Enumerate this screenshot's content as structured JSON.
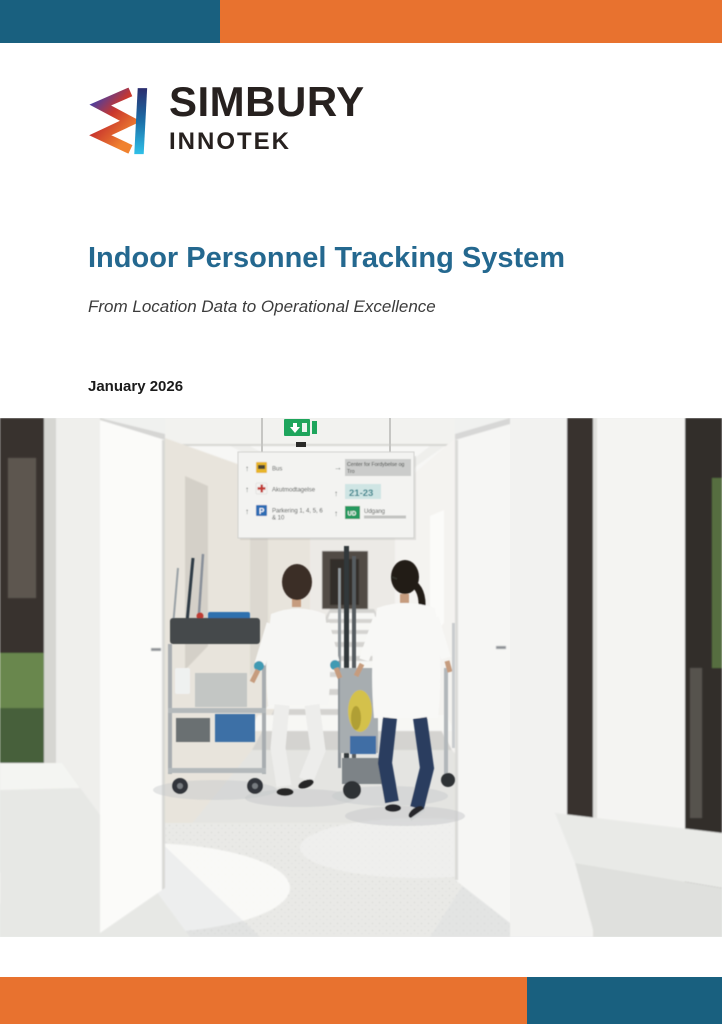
{
  "accent_colors": {
    "teal": "#19607F",
    "orange": "#E8722F",
    "title_blue": "#24688F"
  },
  "logo": {
    "brand": "SIMBURY",
    "sub_brand": "INNOTEK"
  },
  "cover": {
    "title": "Indoor Personnel Tracking System",
    "subtitle": "From Location Data to Operational Excellence",
    "date": "January 2026"
  },
  "photo": {
    "alt": "Two hospital staff members in white uniforms pushing service carts down a bright corridor",
    "signboard": {
      "left_rows": [
        {
          "arrow": "↑",
          "icon": "bus-icon",
          "label": "Bus"
        },
        {
          "arrow": "↑",
          "icon": "emergency-cross-icon",
          "label": "Akutmodtagelse"
        },
        {
          "arrow": "↑",
          "icon": "parking-icon",
          "label_line1": "Parkering 1, 4, 5, 6",
          "label_line2": "& 10"
        }
      ],
      "right_rows": [
        {
          "arrow": "→",
          "label_line1": "Center for Fordybelse og",
          "label_line2": "Tro"
        },
        {
          "arrow": "↑",
          "label": "21-23"
        },
        {
          "arrow": "↑",
          "badge": "UD",
          "label": "Udgang"
        }
      ]
    }
  }
}
